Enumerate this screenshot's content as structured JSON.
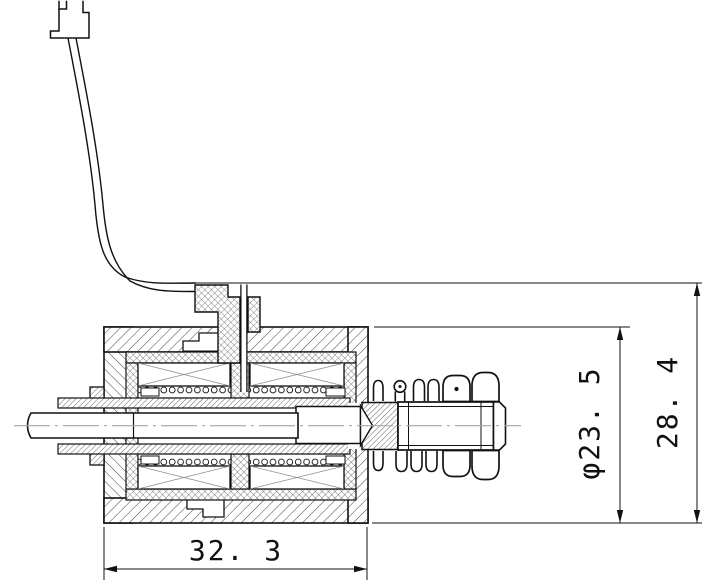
{
  "drawing": {
    "type": "engineering-cross-section",
    "subject": "solenoid-valve-assembly",
    "background_color": "#ffffff",
    "line_color": "#111111",
    "centerline_color": "#a6a6a6",
    "hatch_color": "#2f2f2f",
    "dimensions": {
      "width": {
        "label": "32. 3",
        "value": 32.3,
        "orientation": "horizontal"
      },
      "diameter": {
        "label": "φ23. 5",
        "value": 23.5,
        "orientation": "vertical-rotated"
      },
      "height": {
        "label": "28. 4",
        "value": 28.4,
        "orientation": "vertical-rotated"
      }
    }
  }
}
